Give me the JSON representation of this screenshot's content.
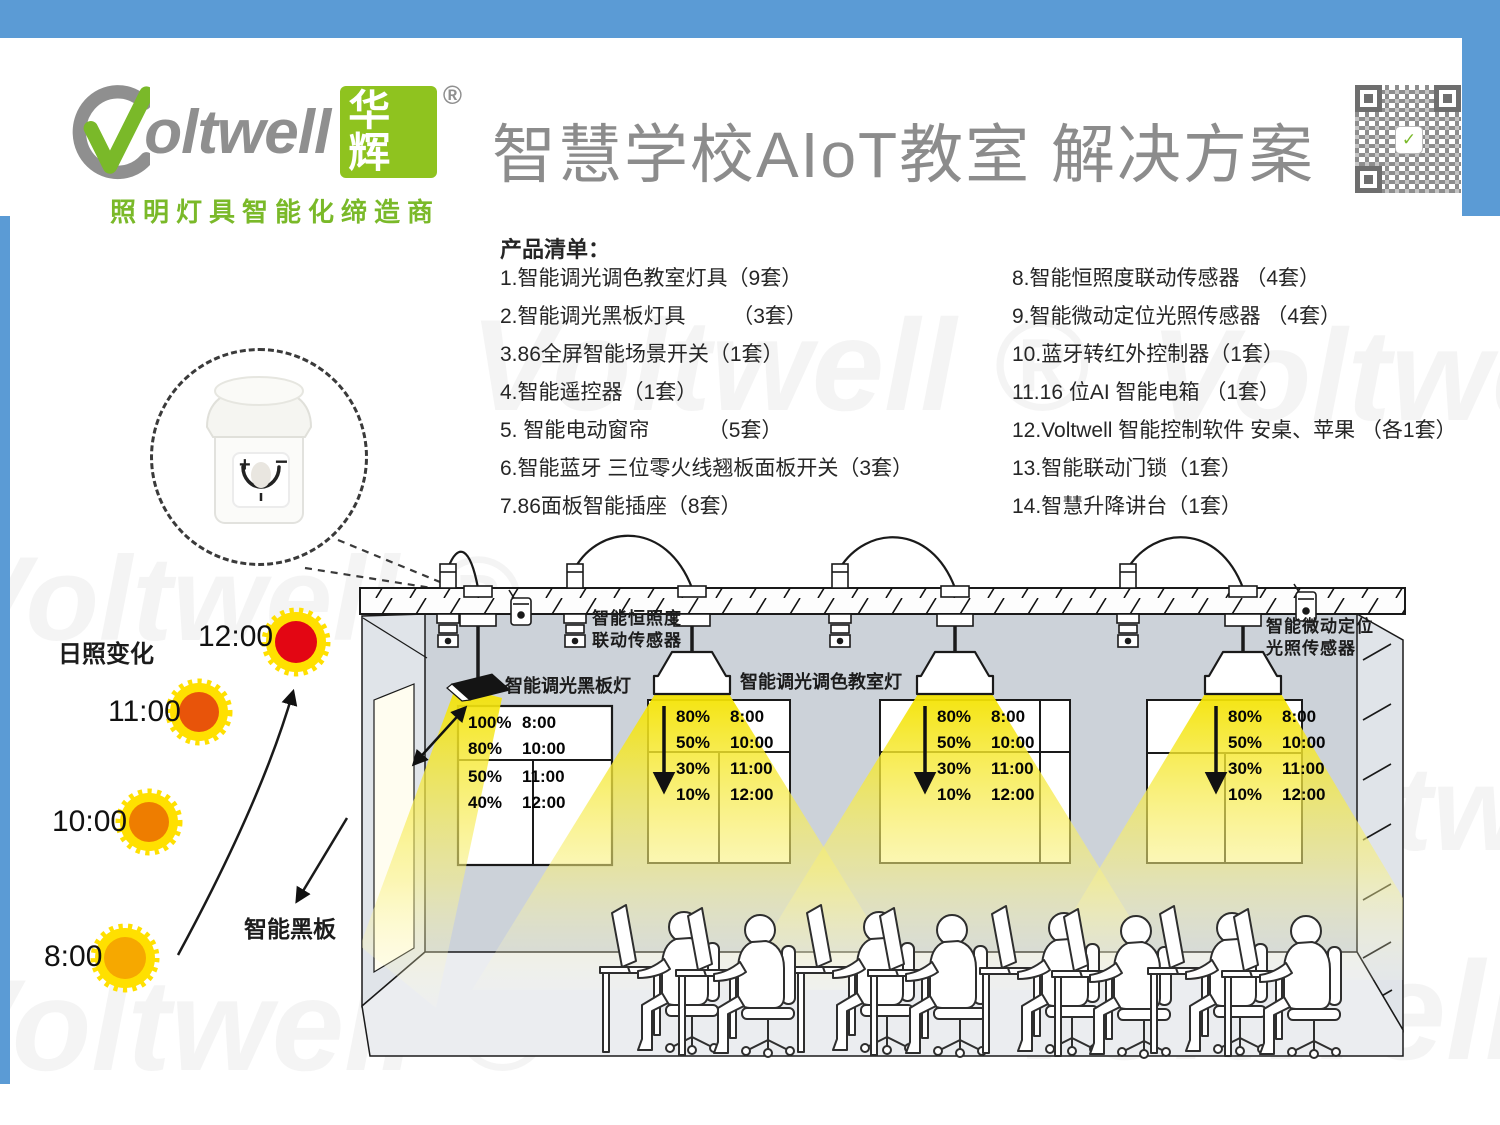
{
  "colors": {
    "accent_blue": "#5B9BD5",
    "logo_green": "#7AB929",
    "logo_box_green": "#8FC31F",
    "logo_gray": "#8F8F8F",
    "beam_yellow": "#F4E300"
  },
  "header": {
    "logo": {
      "brand": "oltwell",
      "brand_cn": "华辉",
      "registered": "®",
      "tagline": "照明灯具智能化缔造商"
    },
    "title": "智慧学校AIoT教室 解决方案",
    "qr_label": "qr-code"
  },
  "products": {
    "heading": "产品清单：",
    "left": [
      "1.智能调光调色教室灯具（9套）",
      "2.智能调光黑板灯具        （3套）",
      "3.86全屏智能场景开关（1套）",
      "4.智能遥控器（1套）",
      "5. 智能电动窗帘          （5套）",
      "6.智能蓝牙 三位零火线翘板面板开关（3套）",
      "7.86面板智能插座（8套）"
    ],
    "right": [
      "8.智能恒照度联动传感器 （4套）",
      "9.智能微动定位光照传感器 （4套）",
      "10.蓝牙转红外控制器（1套）",
      "11.16 位AI 智能电箱 （1套）",
      "12.Voltwell 智能控制软件 安桌、苹果 （各1套）",
      "13.智能联动门锁（1套）",
      "14.智慧升降讲台（1套）"
    ]
  },
  "sun_diagram": {
    "title": "日照变化",
    "suns": [
      {
        "time": "12:00",
        "color": "#E30613"
      },
      {
        "time": "11:00",
        "color": "#E8540A"
      },
      {
        "time": "10:00",
        "color": "#EE7D00"
      },
      {
        "time": "8:00",
        "color": "#F6A800"
      }
    ],
    "blackboard_label": "智能黑板"
  },
  "classroom": {
    "labels": {
      "constant_sensor_line1": "智能恒照度",
      "constant_sensor_line2": "联动传感器",
      "blackboard_light": "智能调光黑板灯",
      "classroom_light": "智能调光调色教室灯",
      "micro_sensor_line1": "智能微动定位",
      "micro_sensor_line2": "光照传感器"
    }
  },
  "schedules": {
    "blackboard": [
      [
        "100%",
        "8:00"
      ],
      [
        "80%",
        "10:00"
      ],
      [
        "50%",
        "11:00"
      ],
      [
        "40%",
        "12:00"
      ]
    ],
    "classroom": [
      [
        "80%",
        "8:00"
      ],
      [
        "50%",
        "10:00"
      ],
      [
        "30%",
        "11:00"
      ],
      [
        "10%",
        "12:00"
      ]
    ]
  },
  "watermark": "Voltwell ®"
}
